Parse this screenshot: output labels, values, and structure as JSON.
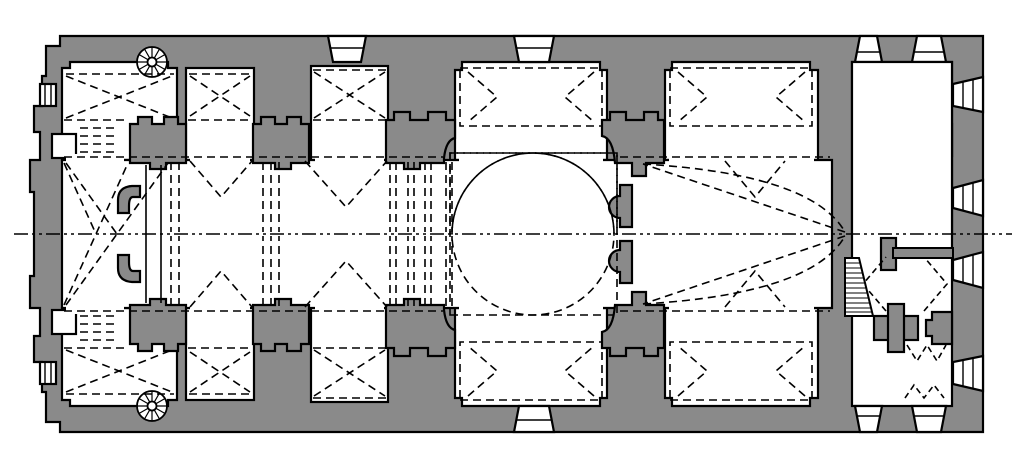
{
  "figure": {
    "kind": "architectural-floor-plan",
    "subject": "single-dome basilica church plan, longitudinal, entrance colonnade at right"
  },
  "colors": {
    "background": "#ffffff",
    "wall": "#8a8a8a",
    "room": "#ffffff",
    "line": "#000000"
  },
  "line_styles": {
    "vault_dash": "8 5",
    "fine_dash": "6 4",
    "axis_dash": "14 4 3 4 3 4"
  },
  "elements": [
    "outer-masonry-walls",
    "nave",
    "side-chapels-with-cross-vault-dashes",
    "barrel-vault-chevron-dashes",
    "central-dome-dashed-circle",
    "crossing-square-dashed",
    "east-bay-apse-dashes",
    "narthex-with-stair-zigzags",
    "spiral-staircase-north",
    "spiral-staircase-south",
    "stair-flight-wedge",
    "perimeter-splayed-windows",
    "facade-colonnade-columns",
    "longitudinal-axis-centerline"
  ]
}
